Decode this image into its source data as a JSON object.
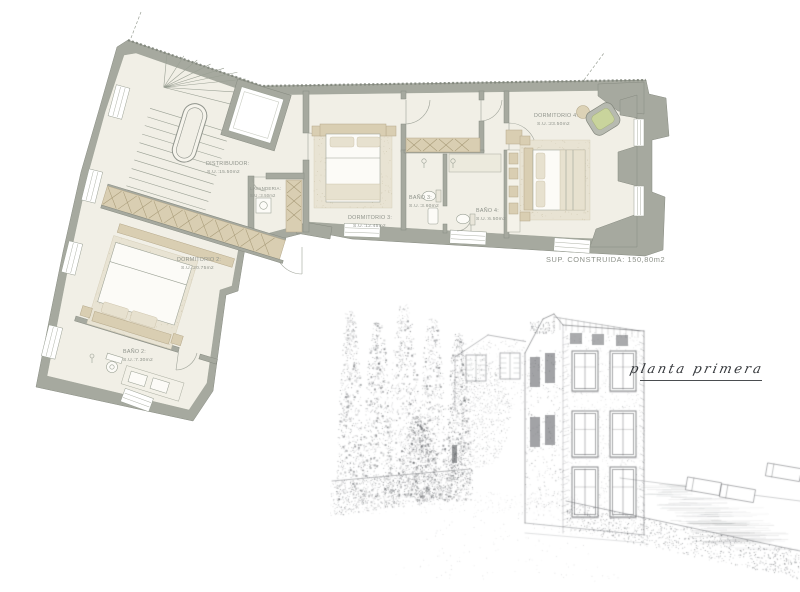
{
  "plan": {
    "rooms": [
      {
        "name": "DISTRIBUIDOR:",
        "area": "S.U.:15.50m2"
      },
      {
        "name": "LAVANDERIA:",
        "area": "S.U.:3.50m2"
      },
      {
        "name": "DORMITORIO 3:",
        "area": "S.U.:12.45m2"
      },
      {
        "name": "BAÑO 3:",
        "area": "S.U.:3.60m2"
      },
      {
        "name": "BAÑO 4:",
        "area": "S.U.:6.50m2"
      },
      {
        "name": "DORMITORIO 4:",
        "area": "S.U.:23.50m2"
      },
      {
        "name": "DORMITORIO 2:",
        "area": "S.U.:20.75m2"
      },
      {
        "name": "BAÑO 2:",
        "area": "S.U.:7.30m2"
      }
    ],
    "total": "SUP.  CONSTRUIDA: 150,80m2"
  },
  "sketch": {
    "caption": "planta primera"
  },
  "colors": {
    "wall": "#a6a99f",
    "floor": "#f1efe6",
    "furniture_tan": "#d9ceb2",
    "cushion_green": "#c9d49c",
    "label_text": "#8f938b",
    "sketch_ink": "#55585c"
  }
}
